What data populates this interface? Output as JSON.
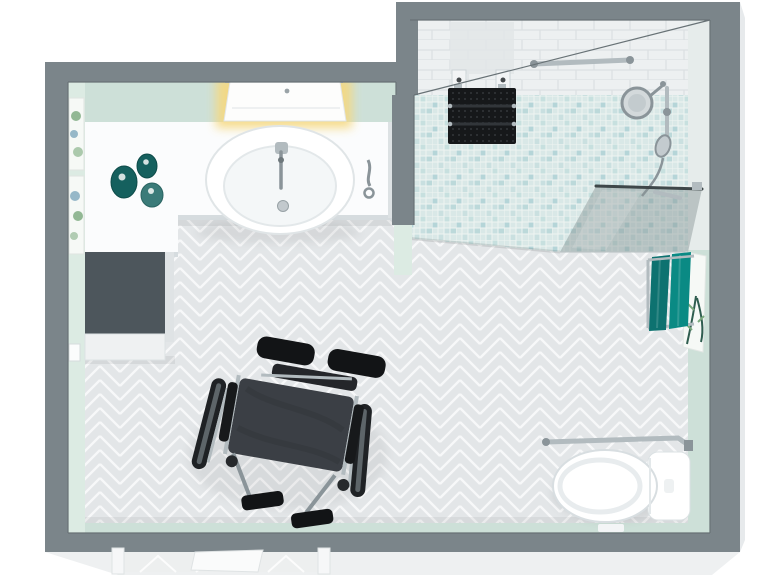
{
  "meta": {
    "title": "Accessible bathroom 3D floor plan, top-down view",
    "type": "3d-floor-plan",
    "room": "accessible-bathroom"
  },
  "palette": {
    "wall_top": "#7b858a",
    "wall_edge": "#687276",
    "exterior_band": "#eef0f1",
    "exterior_side": "#e7eaec",
    "mint": "#cde0d8",
    "mint_light": "#dcebe3",
    "face_light": "#e6eceb",
    "floor_tile": "#e3e6e8",
    "floor_grout": "#f7f8f9",
    "mosaic_base": "#d9e8e7",
    "mosaic_accent": "#a9cfd2",
    "mosaic_accent2": "#c3dedd",
    "mosaic_grid": "#eef4f2",
    "subway": "#edf0f1",
    "subway_line": "#dbe0e2",
    "counter": "#fbfcfd",
    "counter_edge": "#dde2e4",
    "counter_shadow": "#d6dcdf",
    "cabinet_top": "#4d565c",
    "cabinet_front": "#eff1f2",
    "cabinet_side": "#dfe3e5",
    "ceramic": "#ffffff",
    "ceramic_line": "#dbe1e4",
    "chrome": "#b2bbbf",
    "chrome_dark": "#8a9499",
    "frosted": "#e2e6e7",
    "seat_black": "#16181a",
    "slat_gap": "#32363a",
    "glass": "#879594",
    "glass_edge": "#3e4749",
    "towel_a": "#0d7270",
    "towel_b": "#0a8a84",
    "jar_dark": "#15605e",
    "jar_light": "#3b7b79",
    "glow": "#f6d87e",
    "art_paper": "#f6f9f6",
    "art_green": "#79a87c",
    "art_blue": "#6d9cb5",
    "art_deep": "#2f5d4f",
    "wheel_dark": "#1f2225",
    "chair_seat": "#3b3f45",
    "pad_black": "#121416",
    "doorway_floor": "#edefef"
  },
  "scene": {
    "areas": [
      {
        "name": "vanity-area"
      },
      {
        "name": "walk-in-shower"
      },
      {
        "name": "toilet-corner"
      },
      {
        "name": "main-floor"
      }
    ],
    "objects": [
      "outer-walls",
      "door-opening",
      "vanity-counter",
      "wash-basin",
      "basin-faucet",
      "illuminated-mirror-cabinet",
      "storage-cabinet",
      "toiletry-jars",
      "wall-art-prints",
      "light-switch",
      "wheelchair",
      "herringbone-floor",
      "mosaic-shower-floor",
      "fold-down-shower-seat",
      "shower-grab-bar",
      "hand-shower-on-rail",
      "magnifying-mirror",
      "glass-shower-screen",
      "towel-rack-with-towels",
      "botanical-print",
      "toilet",
      "toilet-grab-bar"
    ]
  }
}
